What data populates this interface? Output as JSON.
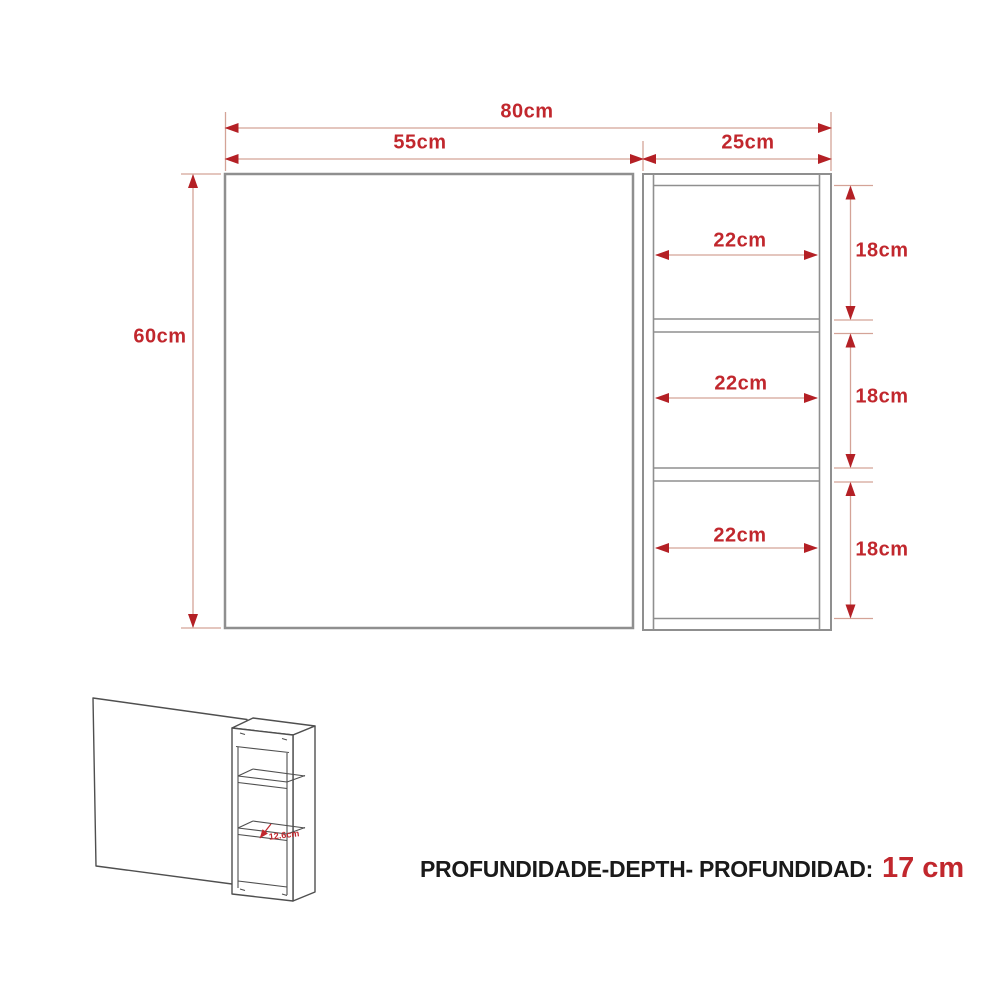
{
  "drawing": {
    "front_view": {
      "total_width_label": "80cm",
      "mirror_width_label": "55cm",
      "shelf_width_label": "25cm",
      "height_label": "60cm",
      "shelf_opening_width_labels": [
        "22cm",
        "22cm",
        "22cm"
      ],
      "shelf_opening_height_labels": [
        "18cm",
        "18cm",
        "18cm"
      ]
    },
    "perspective_view": {
      "shelf_depth_label": "12.6cm"
    },
    "footer": {
      "depth_label": "PROFUNDIDADE-DEPTH- PROFUNDIDAD:",
      "depth_value": "17 cm"
    },
    "colors": {
      "dimension_text_red": "#c1272d",
      "arrowhead_red": "#b42025",
      "dimension_line_pale": "#d4a397",
      "outline_gray": "#8f8f8f",
      "sketch_line_dark": "#4f4f4f",
      "footer_text_black": "#1a1a1a",
      "background": "#ffffff"
    }
  }
}
